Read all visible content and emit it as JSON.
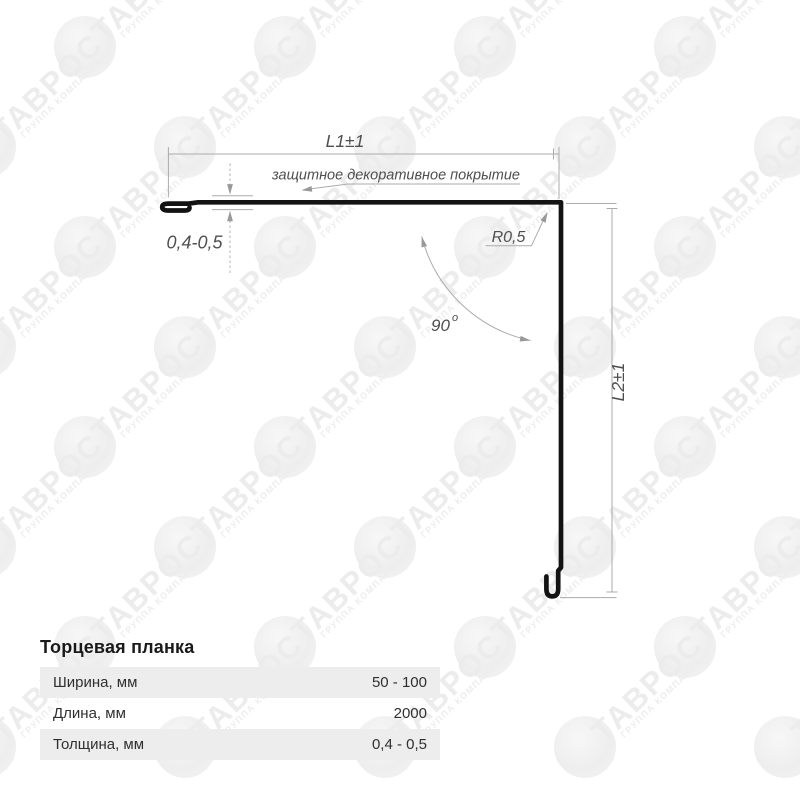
{
  "watermark": {
    "title": "ТАВРОС",
    "subtitle": "ГРУППА КОМПАНИЙ"
  },
  "drawing": {
    "dim_l1": "L1±1",
    "coating_label": "защитное декоративное покрытие",
    "thickness_label": "0,4-0,5",
    "radius_label": "R0,5",
    "angle_value": "90",
    "angle_degree_mark": "o",
    "dim_l2": "L2±1"
  },
  "product": {
    "title": "Торцевая планка",
    "specs": [
      {
        "label": "Ширина, мм",
        "value": "50 - 100"
      },
      {
        "label": "Длина, мм",
        "value": "2000"
      },
      {
        "label": "Толщина, мм",
        "value": "0,4 - 0,5"
      }
    ]
  },
  "colors": {
    "background": "#ffffff",
    "profile_line": "#131313",
    "dimension_line": "#ababab",
    "dimension_text": "#4f4f4f",
    "table_title_text": "#1a1a1a",
    "table_text": "#2f2f2f",
    "table_row_shade": "#ededed",
    "watermark_gray": "#ececec"
  }
}
